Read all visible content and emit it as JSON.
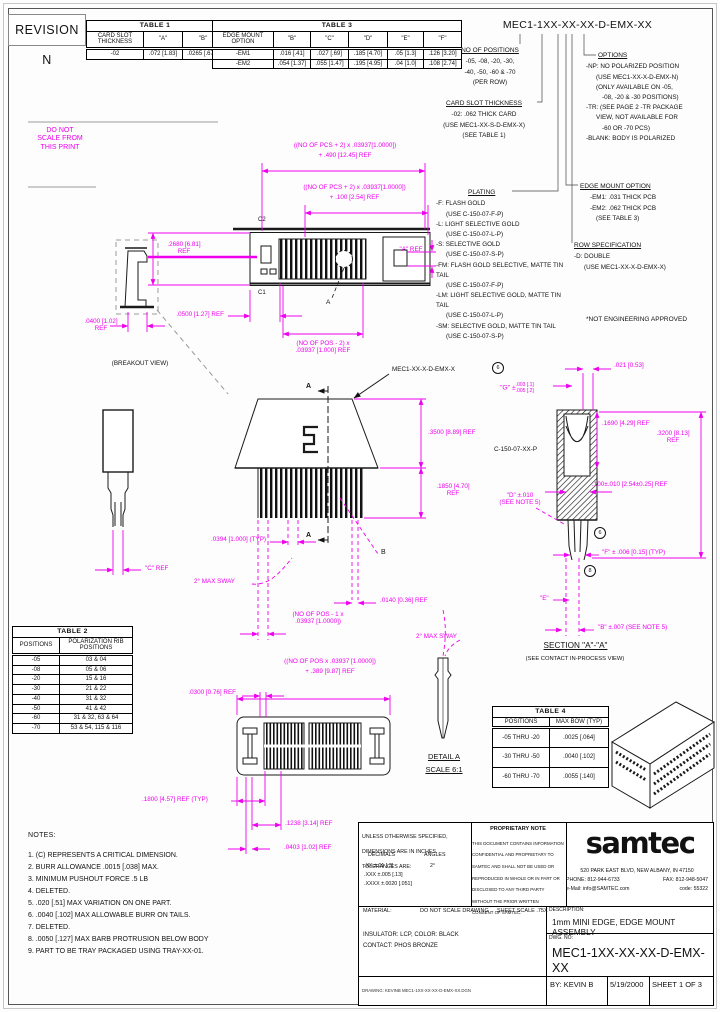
{
  "revision": "REVISION N",
  "do_not_scale": "DO NOT\nSCALE FROM\nTHIS PRINT",
  "part_number": "MEC1-1XX-XX-XX-D-EMX-XX",
  "tables": {
    "t1": {
      "title": "TABLE 1",
      "headers": [
        "CARD SLOT THICKNESS",
        "\"A\"",
        "\"B\""
      ],
      "rows": [
        [
          "-02",
          ".072 [1.83]",
          ".0265 [.673]"
        ]
      ]
    },
    "t3": {
      "title": "TABLE 3",
      "headers": [
        "EDGE MOUNT OPTION",
        "\"B\"",
        "\"C\"",
        "\"D\"",
        "\"E\"",
        "\"F\""
      ],
      "rows": [
        [
          "-EM1",
          ".016 [.41]",
          ".027 [.69]",
          ".185 [4.70]",
          ".05 [1.3]",
          ".126 [3.20]"
        ],
        [
          "-EM2",
          ".054 [1.37]",
          ".055 [1.47]",
          ".195 [4.95]",
          ".04 [1.0]",
          ".108 [2.74]"
        ]
      ]
    },
    "t2": {
      "title": "TABLE 2",
      "headers": [
        "POSITIONS",
        "POLARIZATION RIB POSITIONS"
      ],
      "rows": [
        [
          "-05",
          "03 & 04"
        ],
        [
          "-08",
          "05 & 06"
        ],
        [
          "-20",
          "15 & 16"
        ],
        [
          "-30",
          "21 & 22"
        ],
        [
          "-40",
          "31 & 32"
        ],
        [
          "-50",
          "41 & 42"
        ],
        [
          "-60",
          "31 & 32, 63 & 64"
        ],
        [
          "-70",
          "53 & 54, 115 & 116"
        ]
      ]
    },
    "t4": {
      "title": "TABLE 4",
      "headers": [
        "POSITIONS",
        "MAX BOW (TYP)"
      ],
      "rows": [
        [
          "-05 THRU -20",
          ".0025 [.064]"
        ],
        [
          "-30 THRU -50",
          ".0040 [.102]"
        ],
        [
          "-60 THRU -70",
          ".0055 [.140]"
        ]
      ]
    }
  },
  "specs": {
    "positions": {
      "title": "NO OF POSITIONS",
      "lines": [
        "-05, -08, -20, -30,",
        "-40, -50, -60 & -70",
        "(PER ROW)"
      ]
    },
    "card_slot": {
      "title": "CARD SLOT THICKNESS",
      "lines": [
        "-02: .062 THICK CARD",
        "(USE MEC1-XX-S-D-EMX-X)",
        "(SEE TABLE 1)"
      ]
    },
    "options": {
      "title": "OPTIONS",
      "lines": [
        "-NP: NO POLARIZED POSITION",
        "(USE MEC1-XX-X-D-EMX-N)",
        "(ONLY AVAILABLE ON -05,",
        "-08, -20 & -30 POSITIONS)",
        "-TR: (SEE PAGE 2 -TR PACKAGE",
        "VIEW, NOT AVAILABLE FOR",
        "-60 OR -70 PCS)",
        "-BLANK: BODY IS POLARIZED"
      ]
    },
    "plating": {
      "title": "PLATING",
      "lines": [
        "-F: FLASH GOLD",
        "(USE C-150-07-F-P)",
        "-L: LIGHT SELECTIVE GOLD",
        "(USE C-150-07-L-P)",
        "-S: SELECTIVE GOLD",
        "(USE C-150-07-S-P)",
        "-FM: FLASH GOLD SELECTIVE, MATTE TIN TAIL",
        "(USE C-150-07-F-P)",
        "-LM: LIGHT SELECTIVE GOLD, MATTE TIN TAIL",
        "(USE C-150-07-L-P)",
        "-SM: SELECTIVE GOLD, MATTE TIN TAIL",
        "(USE C-150-07-S-P)"
      ]
    },
    "edge_mount": {
      "title": "EDGE MOUNT OPTION",
      "lines": [
        "-EM1: .031 THICK PCB",
        "-EM2: .062 THICK PCB",
        "(SEE TABLE 3)"
      ]
    },
    "row_spec": {
      "title": "ROW SPECIFICATION",
      "lines": [
        "-D: DOUBLE",
        "(USE MEC1-XX-X-D-EMX-X)"
      ]
    },
    "not_approved": "*NOT ENGINEERING APPROVED"
  },
  "dims": {
    "top_len1a": "((NO OF PCS + 2) x .03937[1.0000])",
    "top_len1b": "+ .490 [12.45] REF",
    "top_len2a": "((NO OF PCS + 2) x .03937[1.0000])",
    "top_len2b": "+ .100 [2.54] REF",
    "h2680": ".2680 [6.81]\nREF",
    "a_ref": "\"A\" REF",
    "w0400": ".0400 [1.02]\nREF",
    "w0500": ".0500 [1.27] REF",
    "pos_span_top": "(NO OF POS - 2) x\n.03937 [1.000] REF",
    "h3500": ".3500 [8.89] REF",
    "h1850": ".1850 [4.70]\nREF",
    "pitch": ".0394 [1.000] (TYP)",
    "sway_side": "2° MAX SWAY",
    "w0140": ".0140 [0.36] REF",
    "c_ref": "\"C\" REF",
    "t021": ".021 [0.53]",
    "g_main": "\"G\" ±",
    "g_top": ".003 [.1]",
    "g_bot": ".005 [.2]",
    "h1690": ".1690 [4.29] REF",
    "h3200": ".3200 [8.13]\nREF",
    "p100": ".100±.010 [2.54±0.25] REF",
    "d_dim": "\"D\" ±.010\n(SEE NOTE 5)",
    "f_dim": "\"F\" ± .006 [0.15] (TYP)",
    "e_dim": "\"E\"",
    "b_dim": "\"B\" ±.007 (SEE NOTE 5)",
    "sway_detail": "2° MAX SWAY",
    "w0300": ".0300 [0.76] REF",
    "bot_len_a": "((NO OF POS x .03937 [1.0000])",
    "bot_len_b": "+ .389 [9.87] REF",
    "pos_span_bot": "(NO OF POS - 1 x\n.03937 [1.0000])",
    "p1800": ".1800 [4.57] REF (TYP)",
    "p1238": ".1238 [3.14] REF",
    "p0403": ".0403 [1.02] REF"
  },
  "marks": {
    "c2": "C2",
    "c1": "C1",
    "a_balloon": "A",
    "sec_a_top": "A",
    "sec_a_bot": "A",
    "b_leader": "B",
    "circ1": "6",
    "circ2": "6",
    "circ3": "8",
    "breakout": "(BREAKOUT VIEW)",
    "detail_title": "DETAIL A",
    "detail_scale": "SCALE 6:1",
    "section_title": "SECTION \"A\"-\"A\"",
    "section_sub": "(SEE CONTACT IN-PROCESS VIEW)",
    "callout_body": "MEC1-XX-X-D-EMX-X",
    "callout_contact": "C-150-07-XX-P"
  },
  "notes": {
    "title": "NOTES:",
    "items": [
      "1. (C) REPRESENTS A CRITICAL DIMENSION.",
      "2. BURR ALLOWANCE .0015 [.038] MAX.",
      "3. MINIMUM PUSHOUT FORCE .5 LB",
      "4. DELETED.",
      "5. .020 [.51] MAX VARIATION ON ONE PART.",
      "6. .0040 [.102] MAX ALLOWABLE BURR ON TAILS.",
      "7. DELETED.",
      "8. .0050 [.127] MAX BARB PROTRUSION BELOW BODY",
      "9. PART TO BE TRAY PACKAGED USING TRAY-XX-01."
    ]
  },
  "title_block": {
    "tol_line1": "UNLESS OTHERWISE SPECIFIED,",
    "tol_line2": "DIMENSIONS ARE IN INCHES.",
    "tol_line3": "TOLERANCES ARE:",
    "decimals": "DECIMALS",
    "angles": "ANGLES",
    "dec_xx": ".XX ±.01 [.3]",
    "angle_val": "2°",
    "dec_xxx": ".XXX ±.005 [.13]",
    "dec_xxxx": ".XXXX ±.0020 [.051]",
    "prop_title": "PROPRIETARY NOTE",
    "prop_lines": [
      "THIS DOCUMENT CONTAINS INFORMATION",
      "CONFIDENTIAL AND PROPRIETARY TO",
      "SAMTEC AND SHALL NOT BE USED OR",
      "REPRODUCED IN WHOLE OR IN PART OR",
      "DISCLOSED TO ANY THIRD PARTY",
      "WITHOUT THE PRIOR WRITTEN",
      "CONSENT OF SAMTEC."
    ],
    "logo": "samtec",
    "address": "520 PARK EAST BLVD, NEW ALBANY, IN 47150",
    "phone": "PHONE: 812-944-6733",
    "fax": "FAX: 812-948-5047",
    "email": "e-Mail: info@SAMTEC.com",
    "code": "code: 55322",
    "material_label": "MATERIAL:",
    "no_scale": "DO NOT SCALE DRAWING",
    "sheet_scale": "SHEET SCALE .75X",
    "description_label": "DESCRIPTION:",
    "description": "1mm MINI EDGE, EDGE MOUNT ASSEMBLY",
    "insulator": "INSULATOR: LCP, COLOR: BLACK",
    "contact": "CONTACT: PHOS BRONZE",
    "dwg_label": "DWG. NO:",
    "dwg_no": "MEC1-1XX-XX-XX-D-EMX-XX",
    "by": "BY:  KEVIN B",
    "date": "5/19/2000",
    "sheet": "SHEET 1 OF 3",
    "file_note": "DRAWING: KEVINB  MEC1-1XX-XX-XX-D-EMX-XX.DGN"
  }
}
